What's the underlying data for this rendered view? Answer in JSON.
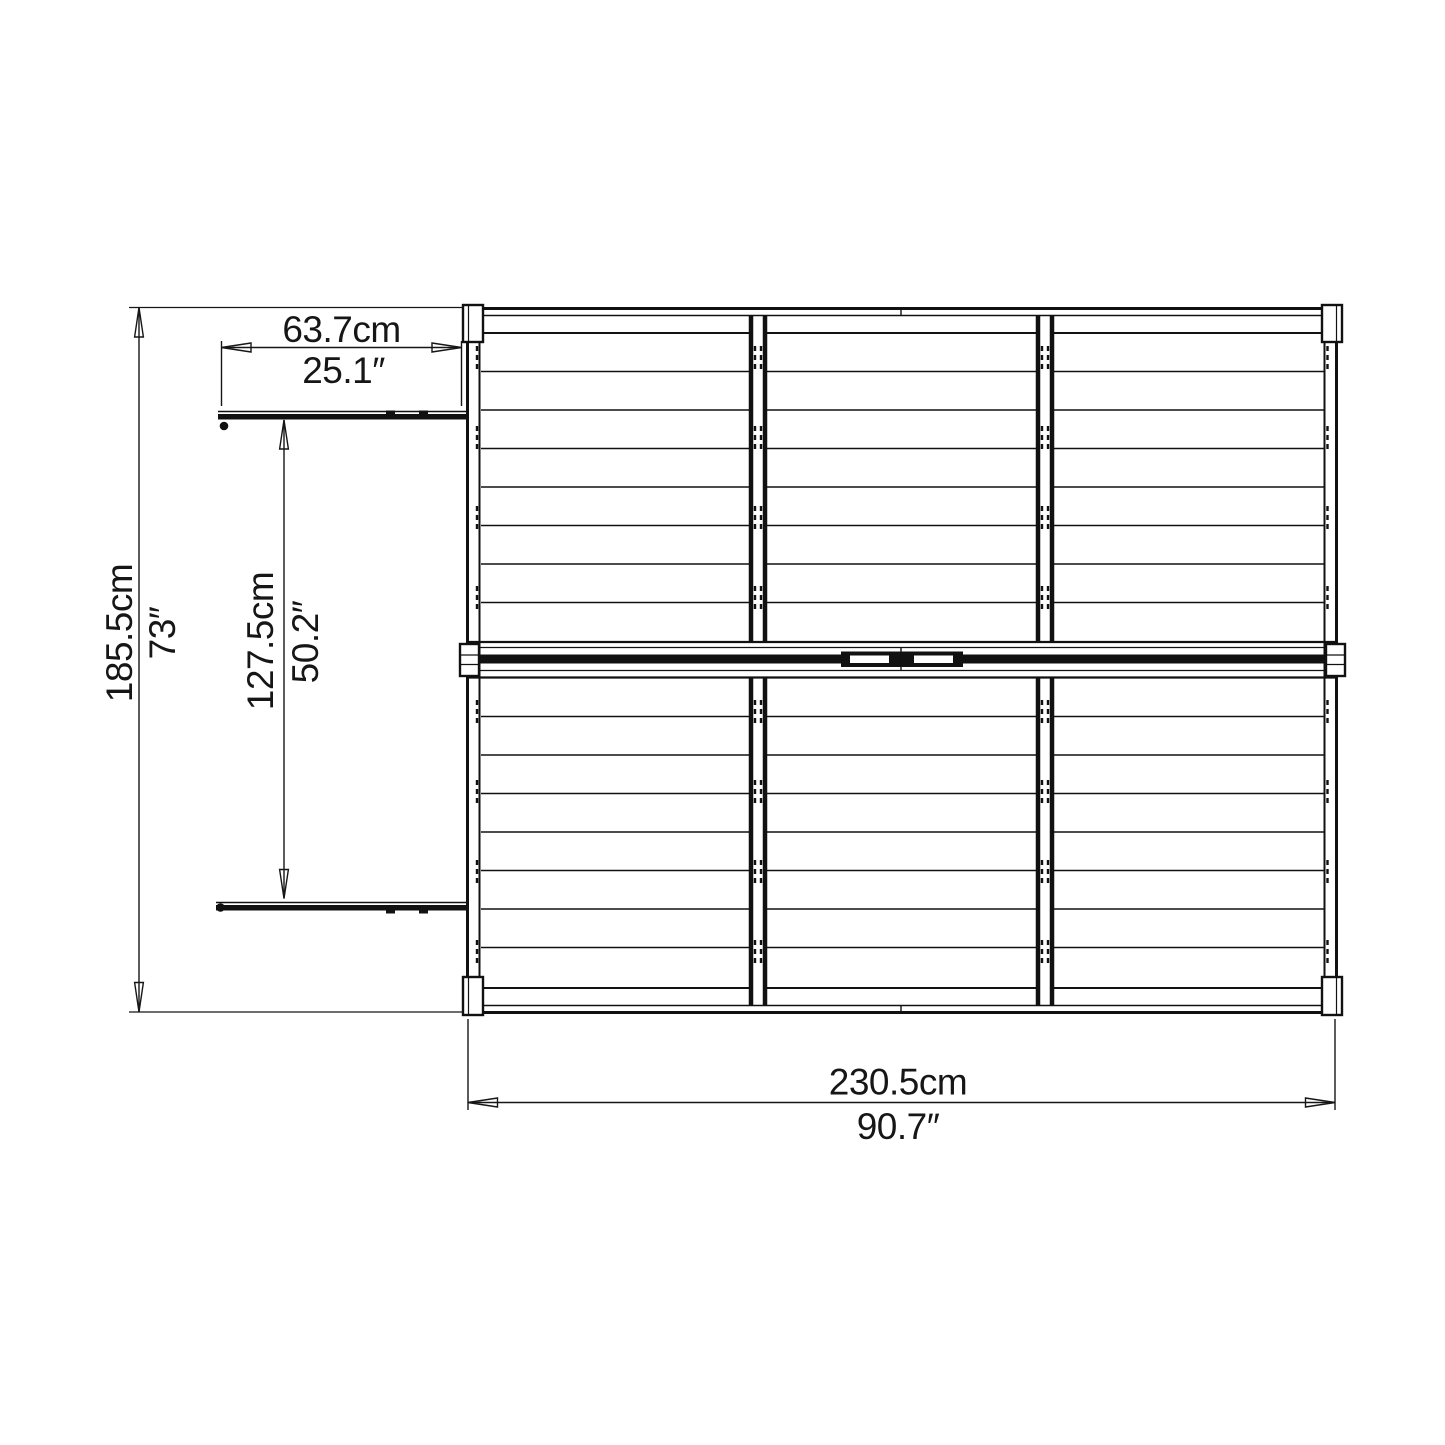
{
  "page": {
    "background": "#ffffff",
    "line_color": "#111111"
  },
  "diagram": {
    "dimensions": {
      "door_width": {
        "cm": "63.7cm",
        "inches": "25.1″"
      },
      "overall_depth": {
        "cm": "185.5cm",
        "inches": "73″"
      },
      "door_opening": {
        "cm": "127.5cm",
        "inches": "50.2″"
      },
      "overall_width": {
        "cm": "230.5cm",
        "inches": "90.7″"
      }
    }
  }
}
